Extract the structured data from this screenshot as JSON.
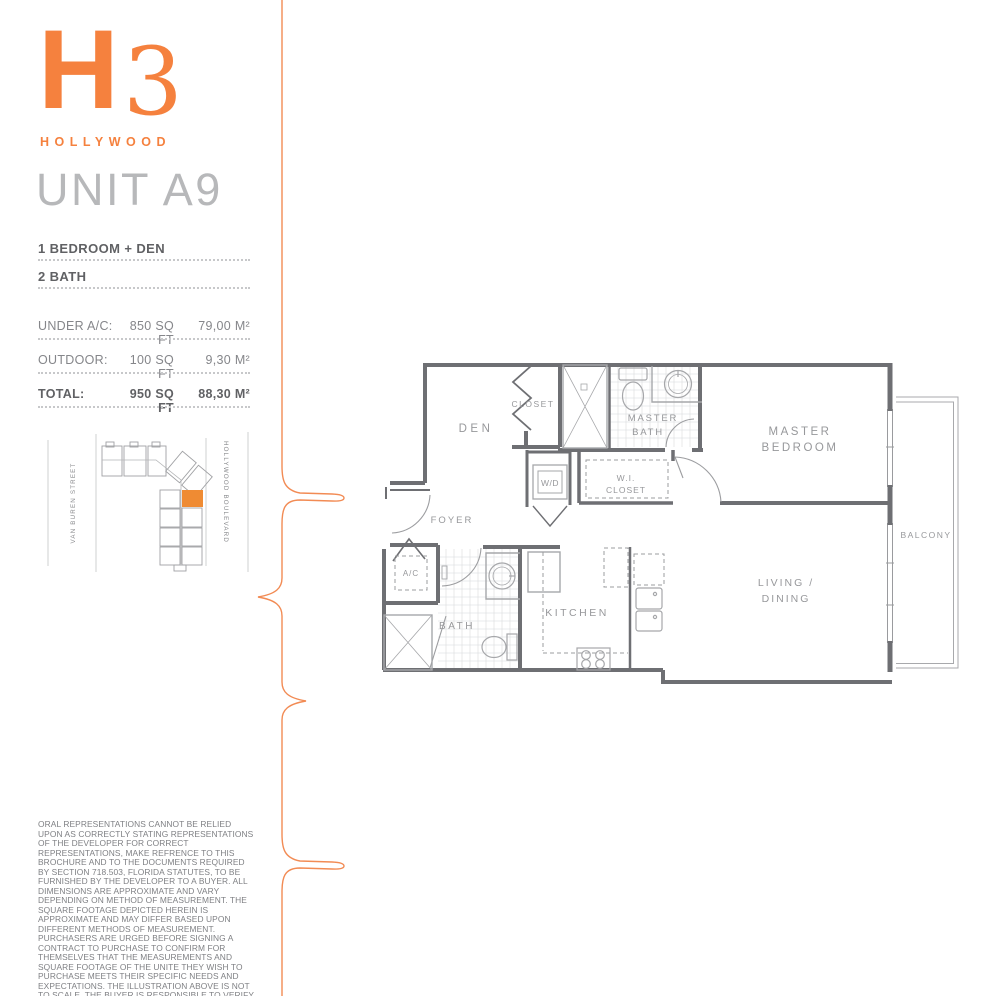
{
  "brand": {
    "logo_h": "H",
    "logo_3": "3",
    "name": "HOLLYWOOD"
  },
  "unit": {
    "title": "UNIT A9"
  },
  "features": {
    "item1": "1 BEDROOM + DEN",
    "item2": "2 BATH"
  },
  "areas": {
    "under_ac": {
      "label": "UNDER A/C:",
      "sqft": "850 SQ FT",
      "sqm": "79,00 M²"
    },
    "outdoor": {
      "label": "OUTDOOR:",
      "sqft": "100 SQ FT",
      "sqm": "9,30 M²"
    },
    "total": {
      "label": "TOTAL:",
      "sqft": "950 SQ FT",
      "sqm": "88,30 M²"
    }
  },
  "site_map": {
    "left_street": "VAN BUREN STREET",
    "right_street": "HOLLYWOOD BOULEVARD"
  },
  "floor_plan": {
    "labels": {
      "den": "DEN",
      "closet": "CLOSET",
      "master_bath_1": "MASTER",
      "master_bath_2": "BATH",
      "master_bedroom_1": "MASTER",
      "master_bedroom_2": "BEDROOM",
      "wd": "W/D",
      "wi_closet_1": "W.I.",
      "wi_closet_2": "CLOSET",
      "foyer": "FOYER",
      "ac": "A/C",
      "bath": "BATH",
      "kitchen": "KITCHEN",
      "living_1": "LIVING /",
      "living_2": "DINING",
      "balcony": "BALCONY"
    }
  },
  "disclaimer": "ORAL REPRESENTATIONS CANNOT BE RELIED UPON AS CORRECTLY STATING REPRESENTATIONS OF THE DEVELOPER FOR CORRECT REPRESENTATIONS, MAKE REFRENCE TO THIS BROCHURE AND TO THE DOCUMENTS REQUIRED BY SECTION 718.503, FLORIDA STATUTES, TO BE FURNISHED BY THE DEVELOPER TO A BUYER. ALL DIMENSIONS ARE APPROXIMATE AND VARY DEPENDING ON METHOD OF MEASUREMENT. THE SQUARE FOOTAGE DEPICTED HEREIN IS APPROXIMATE AND MAY DIFFER BASED UPON DIFFERENT METHODS OF MEASUREMENT. PURCHASERS ARE URGED BEFORE SIGNING A CONTRACT TO PURCHASE TO CONFIRM FOR THEMSELVES THAT THE MEASUREMENTS AND SQUARE FOOTAGE OF THE UNITE THEY WISH TO PURCHASE MEETS THEIR SPECIFIC NEEDS AND EXPECTATIONS. THE ILLUSTRATION ABOVE IS NOT TO SCALE. THE BUYER IS RESPONSIBLE TO VERIFY SQUARE FOOTAGE.",
  "colors": {
    "accent": "#F5813E",
    "deco_line": "#F28B54",
    "wall": "#6E6F73",
    "fixture": "#A6A7AA",
    "tile": "#D6D7D9",
    "plan_label": "#97989B",
    "text_dark": "#606164",
    "text_mid": "#85868A",
    "highlight_unit": "#EF8B33"
  }
}
